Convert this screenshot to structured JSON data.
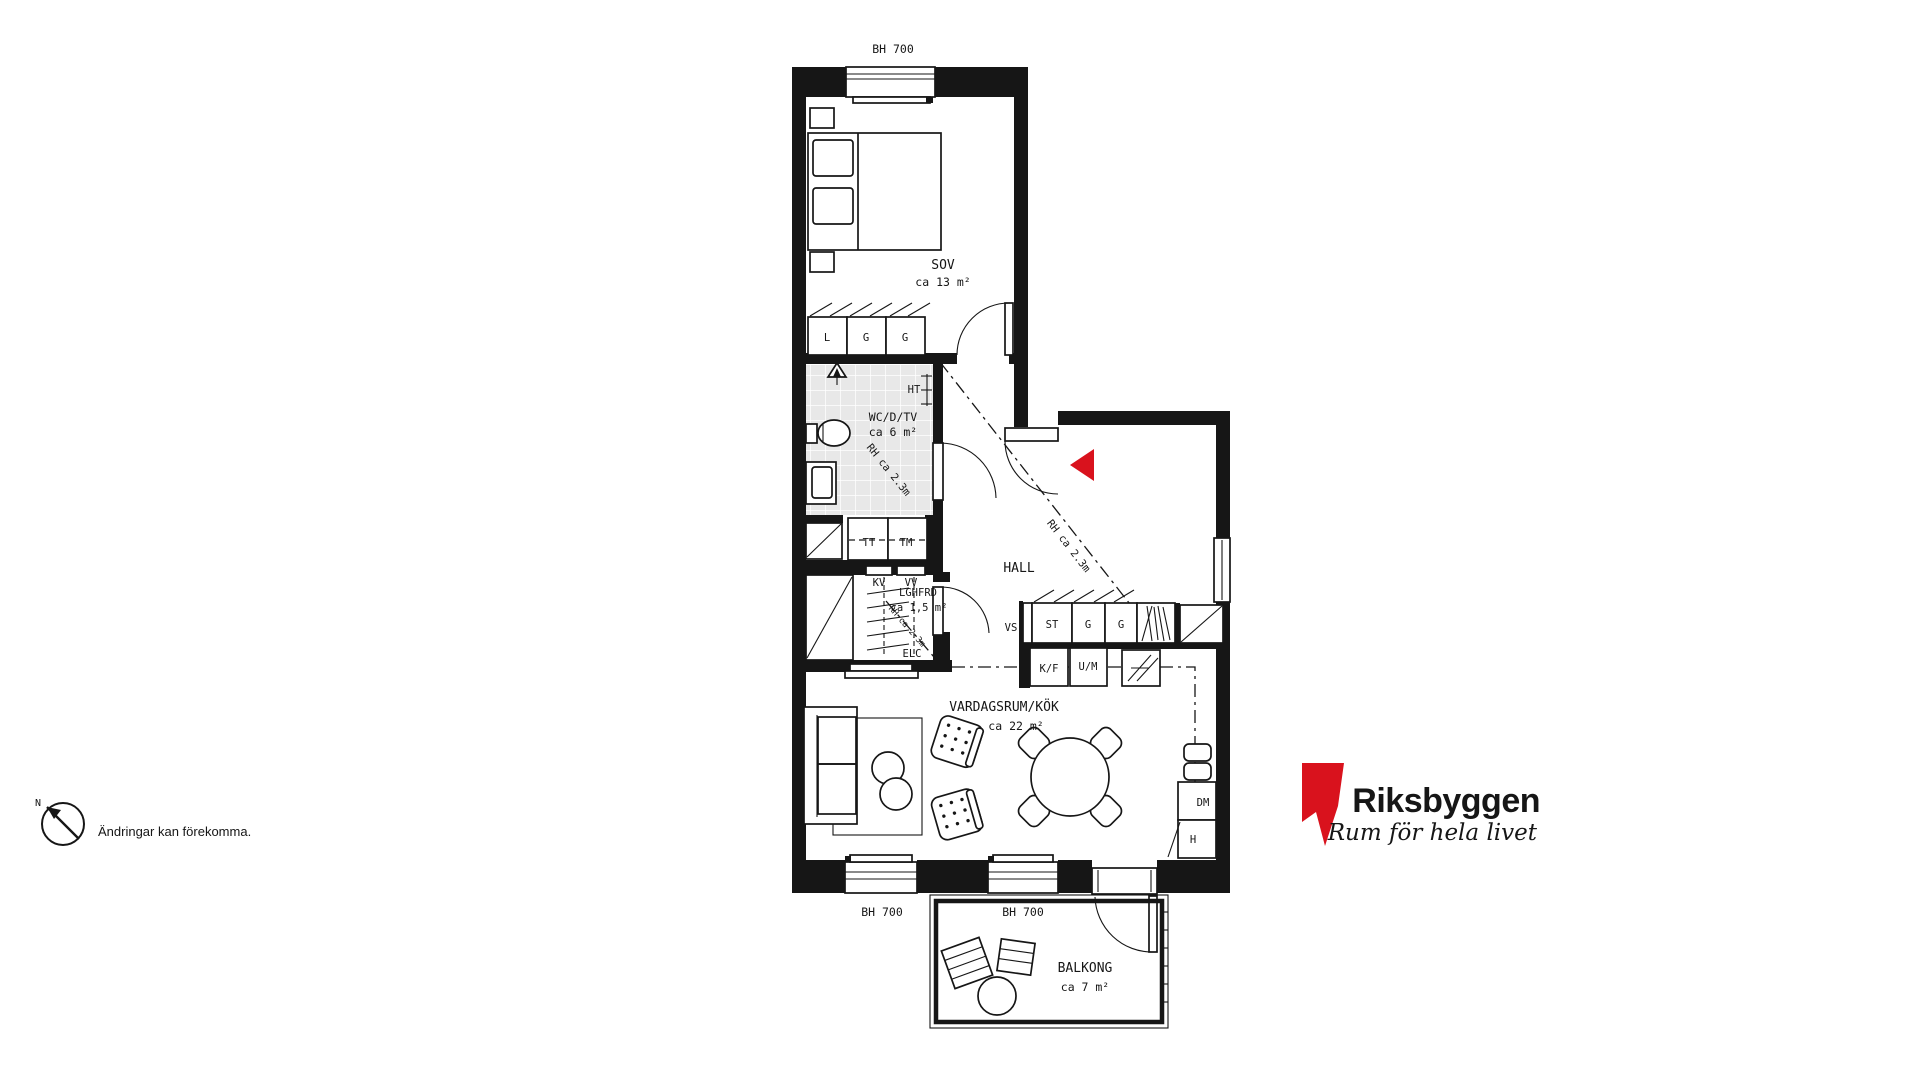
{
  "plan": {
    "window_head_label": "BH 700",
    "rooms": {
      "sov": {
        "name": "SOV",
        "area": "ca 13 m²"
      },
      "wc": {
        "name": "WC/D/TV",
        "area": "ca 6 m²"
      },
      "hall": {
        "name": "HALL"
      },
      "lghfrd": {
        "name": "LGHFRD",
        "area": "ca 1,5 m²"
      },
      "vardagsrum_kok": {
        "name": "VARDAGSRUM/KÖK",
        "area": "ca 22 m²"
      },
      "balkong": {
        "name": "BALKONG",
        "area": "ca 7 m²"
      }
    },
    "fixtures": {
      "linen_cabinet": "L",
      "wardrobe": "G",
      "cleaning_cabinet": "ST",
      "towel_dryer": "HT",
      "tumble_dryer": "TT",
      "washing_machine": "TM",
      "cold_water": "KV",
      "hot_water": "VV",
      "electrical_central": "ELC",
      "water_shaft": "VS",
      "fridge_freezer": "K/F",
      "oven_microwave": "U/M",
      "dishwasher": "DM",
      "tall_cabinet": "H"
    },
    "annotations": {
      "ceiling_height": "RH ca 2.3m"
    }
  },
  "footer": {
    "north_label": "N",
    "disclaimer": "Ändringar kan förekomma."
  },
  "brand": {
    "name": "Riksbyggen",
    "tagline": "Rum för hela livet",
    "red": "#d9121d",
    "gray": "#3b3b3a"
  }
}
